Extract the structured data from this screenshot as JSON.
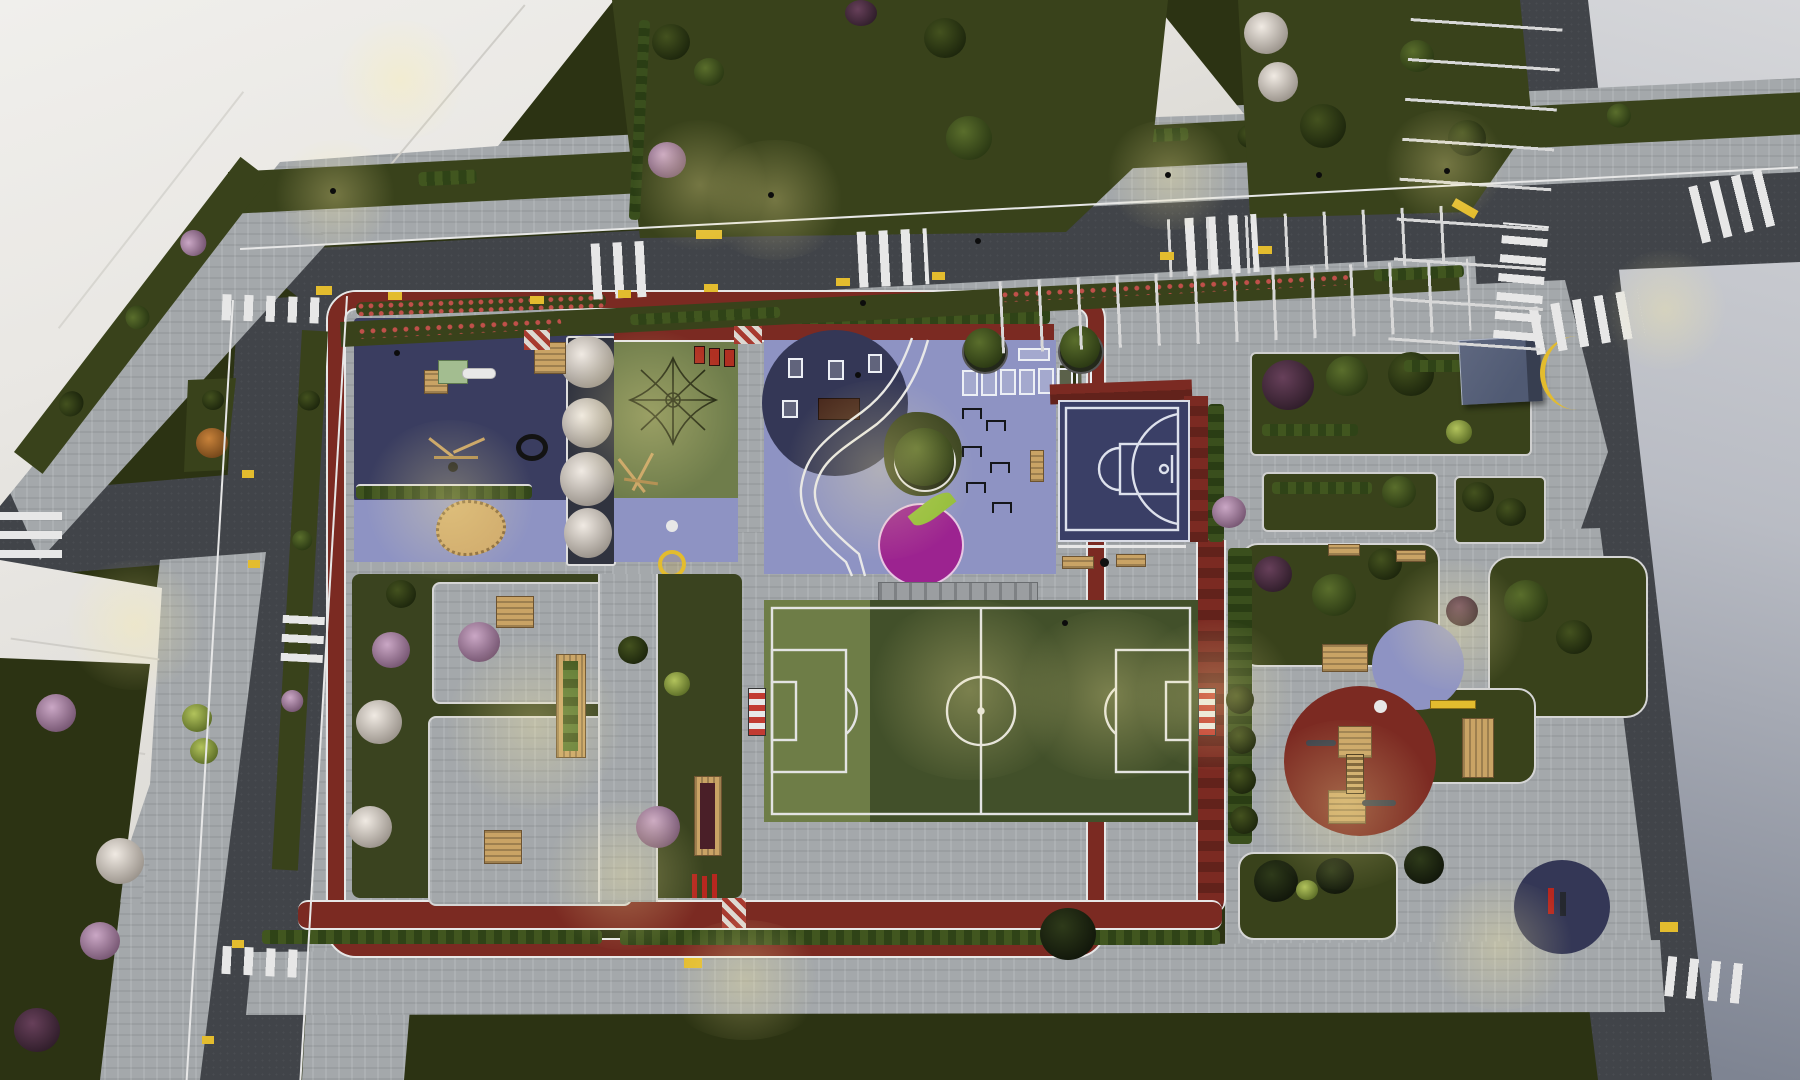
{
  "scene": {
    "type": "aerial-3d-render",
    "time_of_day": "dusk, artificial lighting on",
    "subject": "Bird's-eye architectural rendering of a neighborhood park and sports complex surrounded by streets and white apartment blocks",
    "regions": [
      "apartment-roofs-northwest",
      "apartment-roof-north",
      "apartment-roofs-west",
      "courtyard-lawn-north",
      "lawn-northeast",
      "main-avenue-east",
      "top-street-with-parking",
      "left-street",
      "side-street-stub",
      "kids-playground-navy",
      "sandbox",
      "slide-unit",
      "swing-frame",
      "tire-toy",
      "climbing-net-lawn",
      "flowering-tree-planters",
      "fitness-zone-lavender",
      "gym-equipment-circle",
      "agility-markings",
      "hurdle-stations",
      "magenta-apple-circle",
      "tree-island",
      "basketball-half-court",
      "soccer-field",
      "running-track-border",
      "south-garden-with-picnic-tables",
      "raised-wood-planters",
      "east-garden",
      "toddler-playground-red-circle",
      "wooden-play-towers",
      "purple-play-circle",
      "bike-parking-navy-quarter",
      "kiosk-cube",
      "crosswalks",
      "parking-stalls",
      "street-lamps",
      "hedges-and-flower-beds"
    ]
  },
  "colors": {
    "grass_dark": "#2c3313",
    "grass_mid": "#39421b",
    "grass_park": "#3a431f",
    "asphalt": "#414449",
    "sidewalk": "#a4a8ab",
    "building_white": "#ecebe7",
    "pale_road_light": "#d6d7da",
    "pale_road_dark": "#5d6272",
    "track_red": "#7b2a22",
    "navy_play": "#3a3d60",
    "navy_deep": "#343756",
    "lavender": "#8e93c3",
    "green_play": "#6f7d4b",
    "field_green": "#42502a",
    "field_light": "#6e7d47",
    "court_navy": "#3a3f66",
    "magenta": "#9c2390",
    "leaf_green": "#93bd3a",
    "sand": "#cfa96b",
    "wood": "#c9a365",
    "yellow": "#e3bc2e",
    "white_line": "#e7e7e7",
    "kiosk_top": "#5f6880",
    "kiosk_side": "#373e50",
    "flower_red": "#c0504a",
    "bike_red": "#b7271f"
  }
}
